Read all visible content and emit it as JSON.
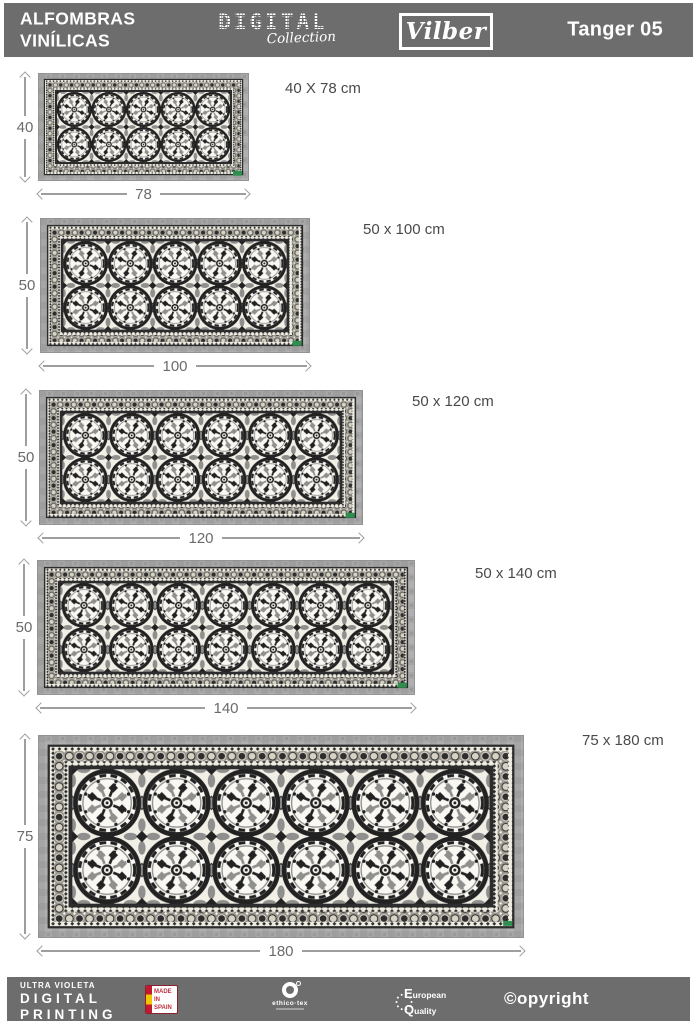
{
  "header": {
    "title_line1": "ALFOMBRAS",
    "title_line2": "VINÍLICAS",
    "collection_top": "DIGITAL",
    "collection_script": "Collection",
    "brand": "Vilber",
    "model": "Tanger 05"
  },
  "rugs": [
    {
      "size_label": "40 X 78 cm",
      "height_label": "40",
      "width_label": "78",
      "height_cm": 40,
      "width_cm": 78,
      "medallions_across": 5,
      "medallions_down": 2
    },
    {
      "size_label": "50 x 100 cm",
      "height_label": "50",
      "width_label": "100",
      "height_cm": 50,
      "width_cm": 100,
      "medallions_across": 5,
      "medallions_down": 2
    },
    {
      "size_label": "50 x 120 cm",
      "height_label": "50",
      "width_label": "120",
      "height_cm": 50,
      "width_cm": 120,
      "medallions_across": 6,
      "medallions_down": 2
    },
    {
      "size_label": "50 x 140 cm",
      "height_label": "50",
      "width_label": "140",
      "height_cm": 50,
      "width_cm": 140,
      "medallions_across": 7,
      "medallions_down": 2
    },
    {
      "size_label": "75 x 180 cm",
      "height_label": "75",
      "width_label": "180",
      "height_cm": 75,
      "width_cm": 180,
      "medallions_across": 6,
      "medallions_down": 2
    }
  ],
  "footer": {
    "print_small": "ULTRA VIOLETA",
    "print_line1": "DIGITAL",
    "print_line2": "PRINTING",
    "made_line1": "MADE",
    "made_line2": "IN",
    "made_line3": "SPAIN",
    "ethico": "ethico·tex",
    "quality_line1": "European",
    "quality_line2": "Quality",
    "copyright": "©opyright"
  },
  "colors": {
    "bar_gray": "#6d6d6d",
    "rug_frame_gray": "#a6a6a6",
    "pattern_dark": "#222222",
    "pattern_gray": "#8f8f8d",
    "pattern_cream": "#f2efe7",
    "flag_red": "#c21a2c",
    "flag_yellow": "#f5c400",
    "mark_green": "#2f8f4f"
  }
}
